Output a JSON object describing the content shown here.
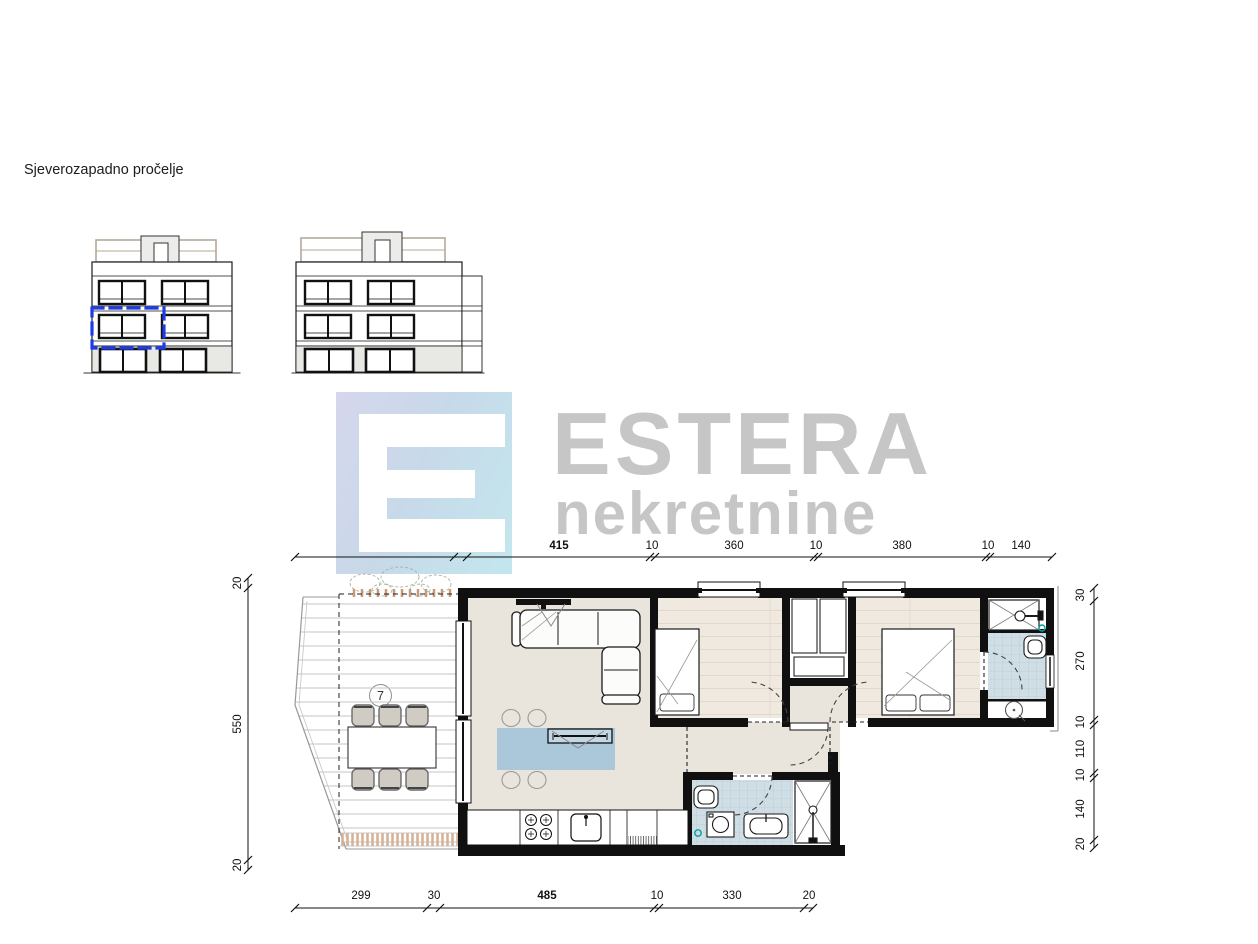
{
  "title": "Sjeverozapadno pročelje",
  "logo": {
    "brand": "ESTERA",
    "subtitle": "nekretnine"
  },
  "plan": {
    "room_labels": [
      {
        "number": "1"
      },
      {
        "number": "2"
      },
      {
        "number": "3"
      },
      {
        "number": "4"
      },
      {
        "number": "5"
      },
      {
        "number": "6"
      },
      {
        "number": "7"
      }
    ],
    "dims_top": [
      "360",
      "30",
      "415",
      "10",
      "360",
      "10",
      "380",
      "10",
      "140"
    ],
    "dims_bottom": [
      "299",
      "30",
      "485",
      "10",
      "330",
      "20"
    ],
    "dims_left": [
      "20",
      "550",
      "20"
    ],
    "dims_right": [
      "30",
      "270",
      "10",
      "110",
      "10",
      "140",
      "20"
    ]
  },
  "colors": {
    "highlight_blue": "#1e3ce6",
    "logo_gray": "#c6c6c6",
    "logo_gradient_start": "#d6d7ec",
    "logo_gradient_end": "#c3e7ee",
    "floor_beige": "#e9e5dc",
    "floor_wood": "#efe9e0",
    "bath_tile": "#cfdde4",
    "island_blue": "#abc8da",
    "planter_tan": "#d8b294",
    "wall_black": "#101010",
    "drain_teal": "#00a0a0"
  }
}
